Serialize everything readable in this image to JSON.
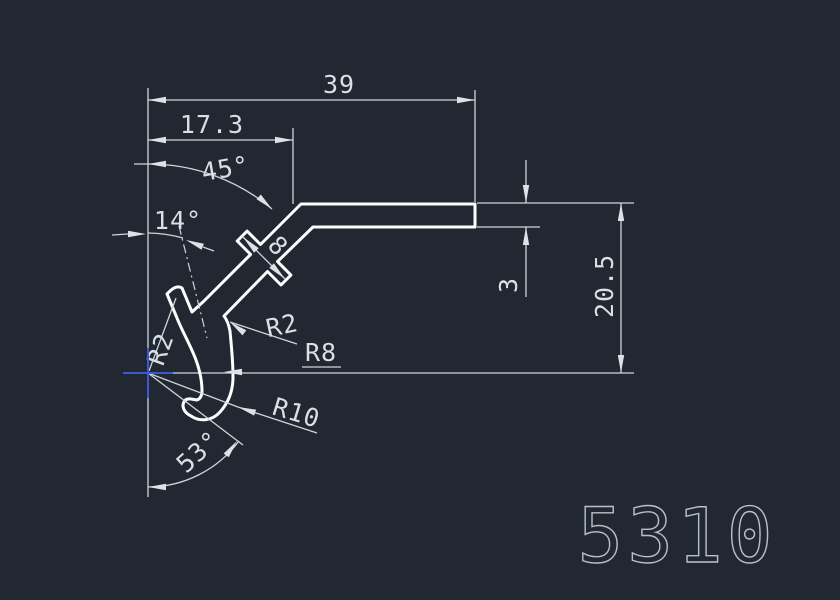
{
  "drawing": {
    "part_number": "5310",
    "dimensions": {
      "overall_width": "39",
      "partial_width": "17.3",
      "slope_angle": "45°",
      "tab_angle": "14°",
      "boss_width": "8",
      "wall_thickness": "3",
      "height": "20.5",
      "fillet_inner": "R2",
      "radius_outer": "R8",
      "radius_tab": "R2",
      "radius_bottom": "R10",
      "hook_angle": "53°"
    },
    "colors": {
      "background": "#212831",
      "profile_line": "#fdfdfd",
      "dimension_line": "#ced4da",
      "dimension_text": "#dadfe4",
      "part_number_text": "#b9c0c7",
      "crosshair": "#3b57d3"
    }
  }
}
